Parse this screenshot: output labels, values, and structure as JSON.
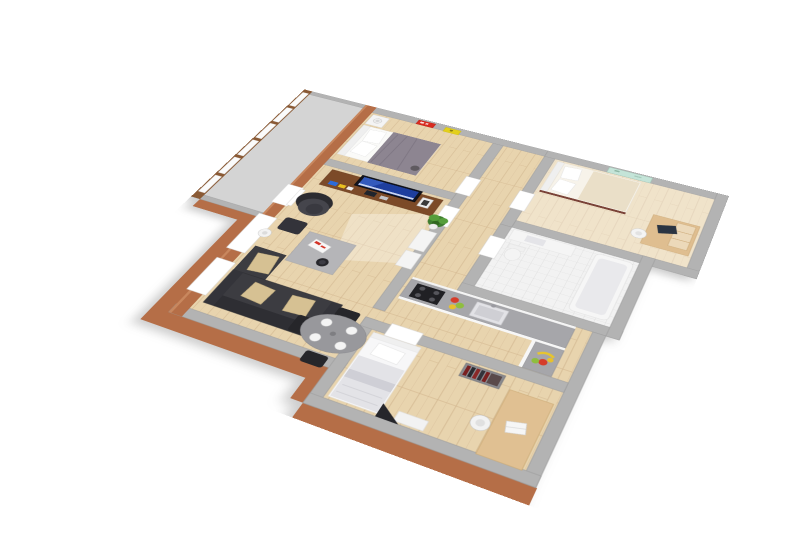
{
  "scene": {
    "type": "3d-floor-plan-render",
    "description": "Axonometric 3D floor plan of an apartment viewed from above, rotated clockwise on a white background",
    "background": "#ffffff",
    "view": {
      "rotation_deg": 25,
      "tilt_deg": 50
    }
  },
  "palette": {
    "background": "#ffffff",
    "floor_wood": "#e8d4ae",
    "floor_wood_seam": "#d8bf98",
    "floor_tile": "#f2f2f2",
    "tile_line": "#dadada",
    "balcony_floor": "#d4d4d4",
    "wall_cap": "#b3b3b3",
    "wall_edge": "#9b9b9b",
    "terracotta": "#b56e47",
    "terracotta_light": "#c8875e",
    "window_frame": "#8a5a35",
    "glass": "#fbfbfb",
    "threshold": "#ffffff",
    "sofa": "#3c3c41",
    "sofa_back": "#2e2e33",
    "cushion": "#d6c193",
    "dining_table": "#98989c",
    "chair": "#26262a",
    "tv_stand": "#7c4a28",
    "tv_screen": "#1e3e9e",
    "plant": "#3f7d2f",
    "duvet_gray": "#8d8591",
    "bed_white": "#f7f3ea",
    "blanket_cream": "#eadfc8",
    "poster_red": "#d92b1f",
    "poster_yellow": "#e3cf1b",
    "painting_mint": "#c4e4d8",
    "counter": "#a6a6aa",
    "stove": "#202024",
    "fruit_red": "#d63c2a",
    "fruit_yellow": "#e8c12c",
    "fruit_green": "#8fbe3f",
    "desk_wood": "#dfbe90",
    "laptop_dark": "#2a3442",
    "lamp_white": "#f3f3f3"
  },
  "rooms": [
    {
      "id": "balcony",
      "name": "Balcony",
      "floor": "concrete",
      "features": [
        "glazed wall of 6 brown-framed windows",
        "terracotta exterior walls"
      ]
    },
    {
      "id": "master-bedroom",
      "name": "Master Bedroom",
      "floor": "wood",
      "furniture": [
        "double bed with gray duvet",
        "white pillows",
        "nightstand",
        "table lamp",
        "red wall poster",
        "yellow wall poster"
      ]
    },
    {
      "id": "living-room",
      "name": "Living Room",
      "floor": "wood",
      "furniture": [
        "tv stand",
        "tv",
        "photo frame",
        "potted plant",
        "armchair",
        "ottoman",
        "floor lamp",
        "coffee table",
        "book",
        "bowl",
        "dark corner sofa with beige cushions",
        "oval dining table",
        "4 dining chairs",
        "4 place settings",
        "white sideboard"
      ]
    },
    {
      "id": "hallway",
      "name": "Hallway",
      "floor": "wood",
      "furniture": []
    },
    {
      "id": "bedroom-2",
      "name": "Bedroom 2",
      "floor": "wood",
      "furniture": [
        "single bed with cream blanket",
        "desk",
        "dark laptop",
        "desk chair",
        "mint wall picture"
      ]
    },
    {
      "id": "bathroom",
      "name": "Bathroom",
      "floor": "tile",
      "furniture": [
        "vanity sink",
        "toilet",
        "bathtub"
      ]
    },
    {
      "id": "kitchen",
      "name": "Kitchen",
      "floor": "wood",
      "furniture": [
        "L-shaped counter",
        "stove with burners",
        "sink with tap",
        "fruit group",
        "bananas"
      ]
    },
    {
      "id": "bedroom-3",
      "name": "Bedroom 3",
      "floor": "wood",
      "furniture": [
        "single bed",
        "shelf with books",
        "desk",
        "white laptop",
        "desk chair",
        "dresser",
        "dark triangle bag"
      ]
    }
  ]
}
